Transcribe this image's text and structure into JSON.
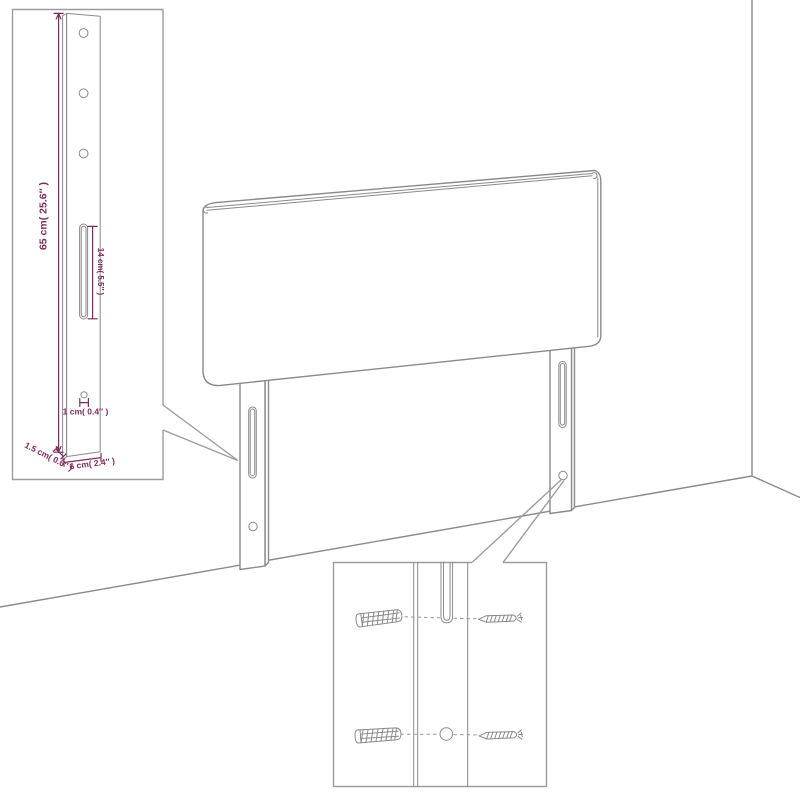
{
  "colors": {
    "line": "#8a8a8a",
    "line_light": "#9c9c9c",
    "dimension": "#7d2b5c",
    "background": "#ffffff"
  },
  "leg_detail_inset": {
    "labels": {
      "leg_height": "65 cm( 25.6″ )",
      "slot_length": "14 cm( 5.5″ )",
      "hole_diameter": "1 cm( 0.4″ )",
      "leg_thickness": "1.5 cm( 0.6″ )",
      "leg_width": "6 cm( 2.4″ )"
    }
  }
}
